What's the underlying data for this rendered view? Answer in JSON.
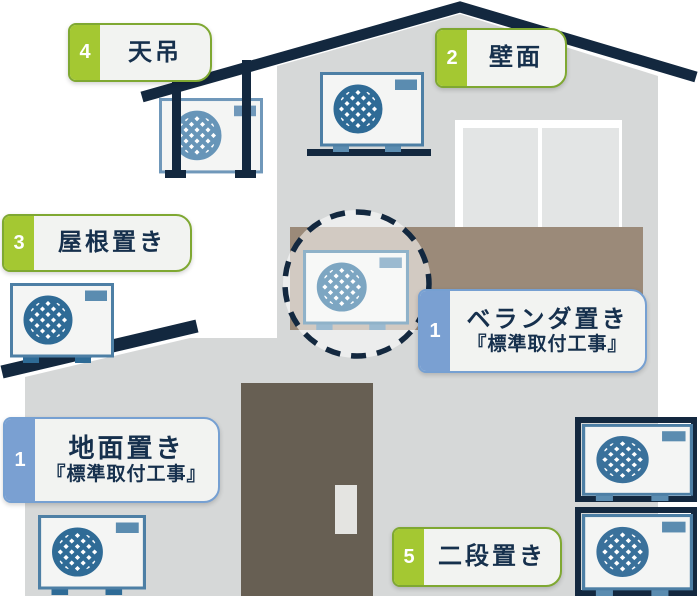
{
  "diagram": {
    "subject": "air-conditioner outdoor unit installation locations on a two-story house"
  },
  "labels": [
    {
      "number": "4",
      "text": "天吊"
    },
    {
      "number": "2",
      "text": "壁面"
    },
    {
      "number": "3",
      "text": "屋根置き"
    },
    {
      "number": "1",
      "text": "ベランダ置き",
      "subtext": "『標準取付工事』"
    },
    {
      "number": "1",
      "text": "地面置き",
      "subtext": "『標準取付工事』"
    },
    {
      "number": "5",
      "text": "二段置き"
    }
  ],
  "colors": {
    "roof_navy": "#13283f",
    "wall_gray": "#d6d8d8",
    "window_pane_gray": "#e3e5e5",
    "balcony_brown": "#9b8a79",
    "door_brown": "#675f53",
    "door_handle": "#e4e4e1",
    "label_green": "#a4c832",
    "label_green_border": "#7fa832",
    "label_blue": "#7aa0d2",
    "label_blue_border": "#76a0d2",
    "label_bg": "#f2f3f1",
    "text_navy": "#16304d",
    "unit_frame_blue": "#4d7fa5",
    "unit_fan_blue": "#2f6b96",
    "unit_vent_blue": "#5b8cb0",
    "unit_light_blue": "#7098ba",
    "unit_lighter_blue": "#8fb2c9",
    "highlight_overlay": "rgba(255,255,255,0.55)"
  },
  "icons": {
    "ac_outdoor_unit": "ac-outdoor-unit-icon",
    "house": "house-illustration",
    "dashed_circle": "dashed-highlight-circle-icon",
    "roof_beam": "roof-beam",
    "window": "window",
    "door": "door",
    "balcony": "balcony-rail"
  }
}
